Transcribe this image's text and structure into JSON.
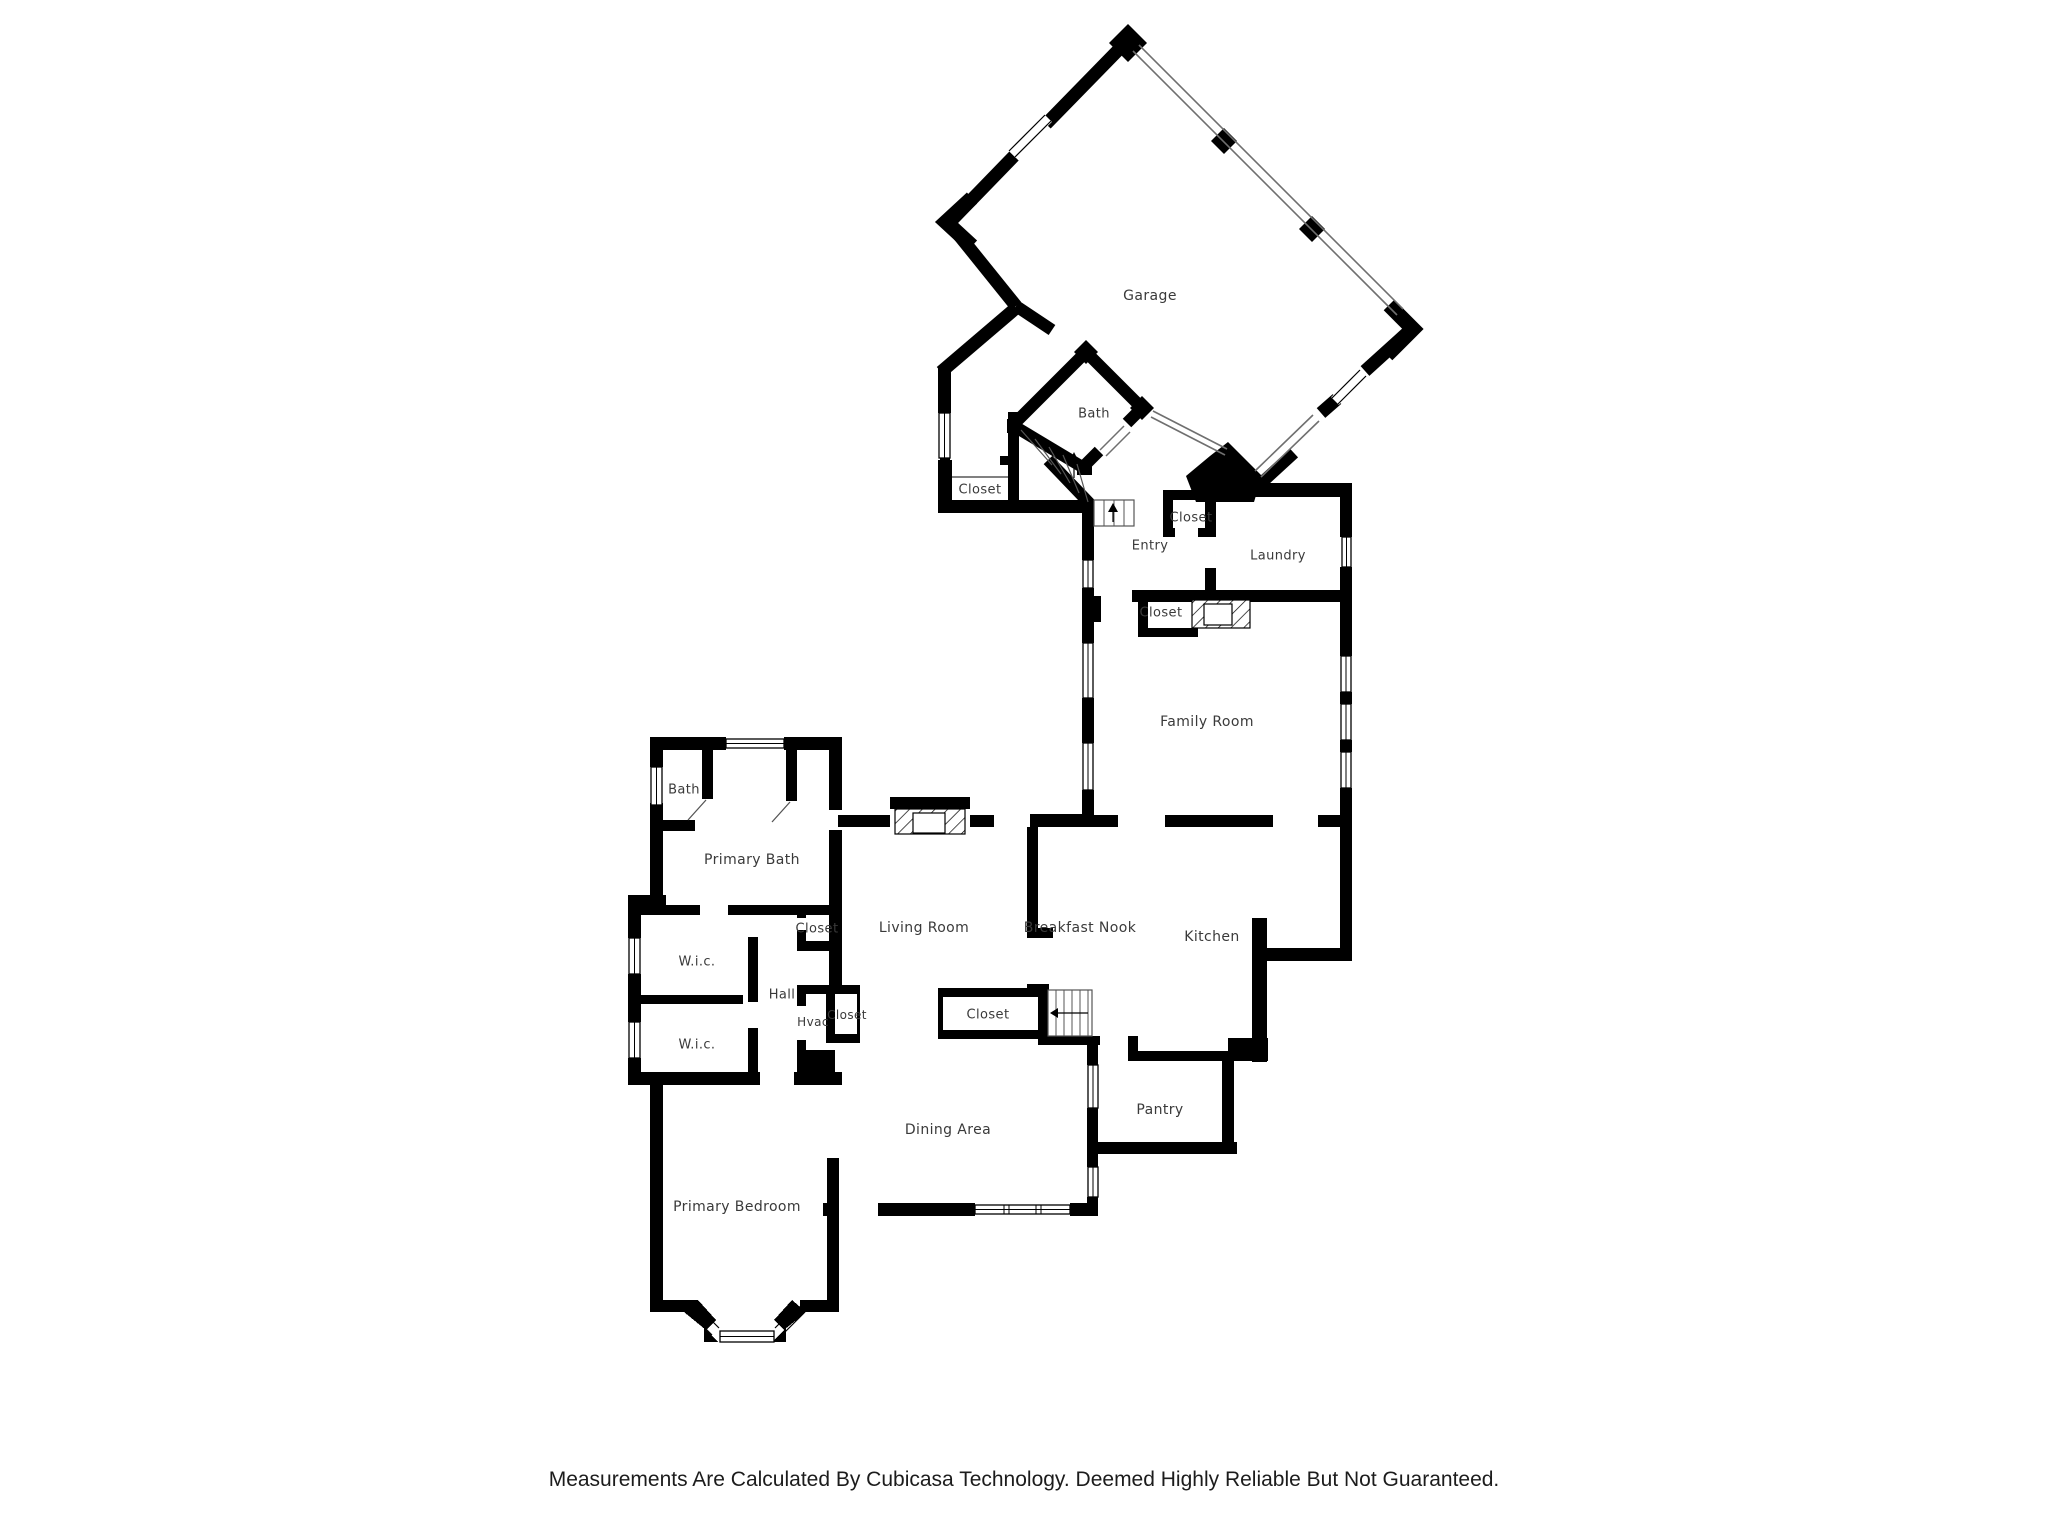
{
  "page": {
    "background": "#ffffff"
  },
  "floorplan": {
    "wall_color": "#000000",
    "label_color": "#3a3a3a",
    "width": 2048,
    "height": 1536,
    "rooms": [
      {
        "id": "garage",
        "label": "Garage",
        "x": 1150,
        "y": 296,
        "fs": 14
      },
      {
        "id": "bath-garage",
        "label": "Bath",
        "x": 1094,
        "y": 414,
        "fs": 13
      },
      {
        "id": "closet-stairs",
        "label": "Closet",
        "x": 980,
        "y": 490,
        "fs": 13
      },
      {
        "id": "closet-entry",
        "label": "Closet",
        "x": 1191,
        "y": 518,
        "fs": 13
      },
      {
        "id": "entry",
        "label": "Entry",
        "x": 1150,
        "y": 546,
        "fs": 13
      },
      {
        "id": "laundry",
        "label": "Laundry",
        "x": 1278,
        "y": 556,
        "fs": 13
      },
      {
        "id": "closet-coat",
        "label": "Closet",
        "x": 1161,
        "y": 613,
        "fs": 13
      },
      {
        "id": "family-room",
        "label": "Family Room",
        "x": 1207,
        "y": 722,
        "fs": 14
      },
      {
        "id": "bath",
        "label": "Bath",
        "x": 684,
        "y": 790,
        "fs": 13
      },
      {
        "id": "primary-bath",
        "label": "Primary Bath",
        "x": 752,
        "y": 860,
        "fs": 14
      },
      {
        "id": "wic-upper",
        "label": "W.i.c.",
        "x": 697,
        "y": 962,
        "fs": 13
      },
      {
        "id": "closet-primary",
        "label": "Closet",
        "x": 817,
        "y": 929,
        "fs": 13
      },
      {
        "id": "hall",
        "label": "Hall",
        "x": 782,
        "y": 995,
        "fs": 13
      },
      {
        "id": "hvac",
        "label": "Hvac",
        "x": 813,
        "y": 1022,
        "fs": 12
      },
      {
        "id": "closet-hall",
        "label": "Closet",
        "x": 847,
        "y": 1015,
        "fs": 12
      },
      {
        "id": "wic-lower",
        "label": "W.i.c.",
        "x": 697,
        "y": 1045,
        "fs": 13
      },
      {
        "id": "living-room",
        "label": "Living Room",
        "x": 924,
        "y": 928,
        "fs": 14
      },
      {
        "id": "closet-center",
        "label": "Closet",
        "x": 988,
        "y": 1015,
        "fs": 13
      },
      {
        "id": "breakfast-nook",
        "label": "Breakfast Nook",
        "x": 1080,
        "y": 928,
        "fs": 14
      },
      {
        "id": "kitchen",
        "label": "Kitchen",
        "x": 1212,
        "y": 937,
        "fs": 14
      },
      {
        "id": "pantry",
        "label": "Pantry",
        "x": 1160,
        "y": 1110,
        "fs": 14
      },
      {
        "id": "dining-area",
        "label": "Dining Area",
        "x": 948,
        "y": 1130,
        "fs": 14
      },
      {
        "id": "primary-bedroom",
        "label": "Primary Bedroom",
        "x": 737,
        "y": 1207,
        "fs": 14
      }
    ]
  },
  "footer": {
    "disclaimer": "Measurements Are Calculated By Cubicasa Technology. Deemed Highly Reliable But Not Guaranteed."
  }
}
